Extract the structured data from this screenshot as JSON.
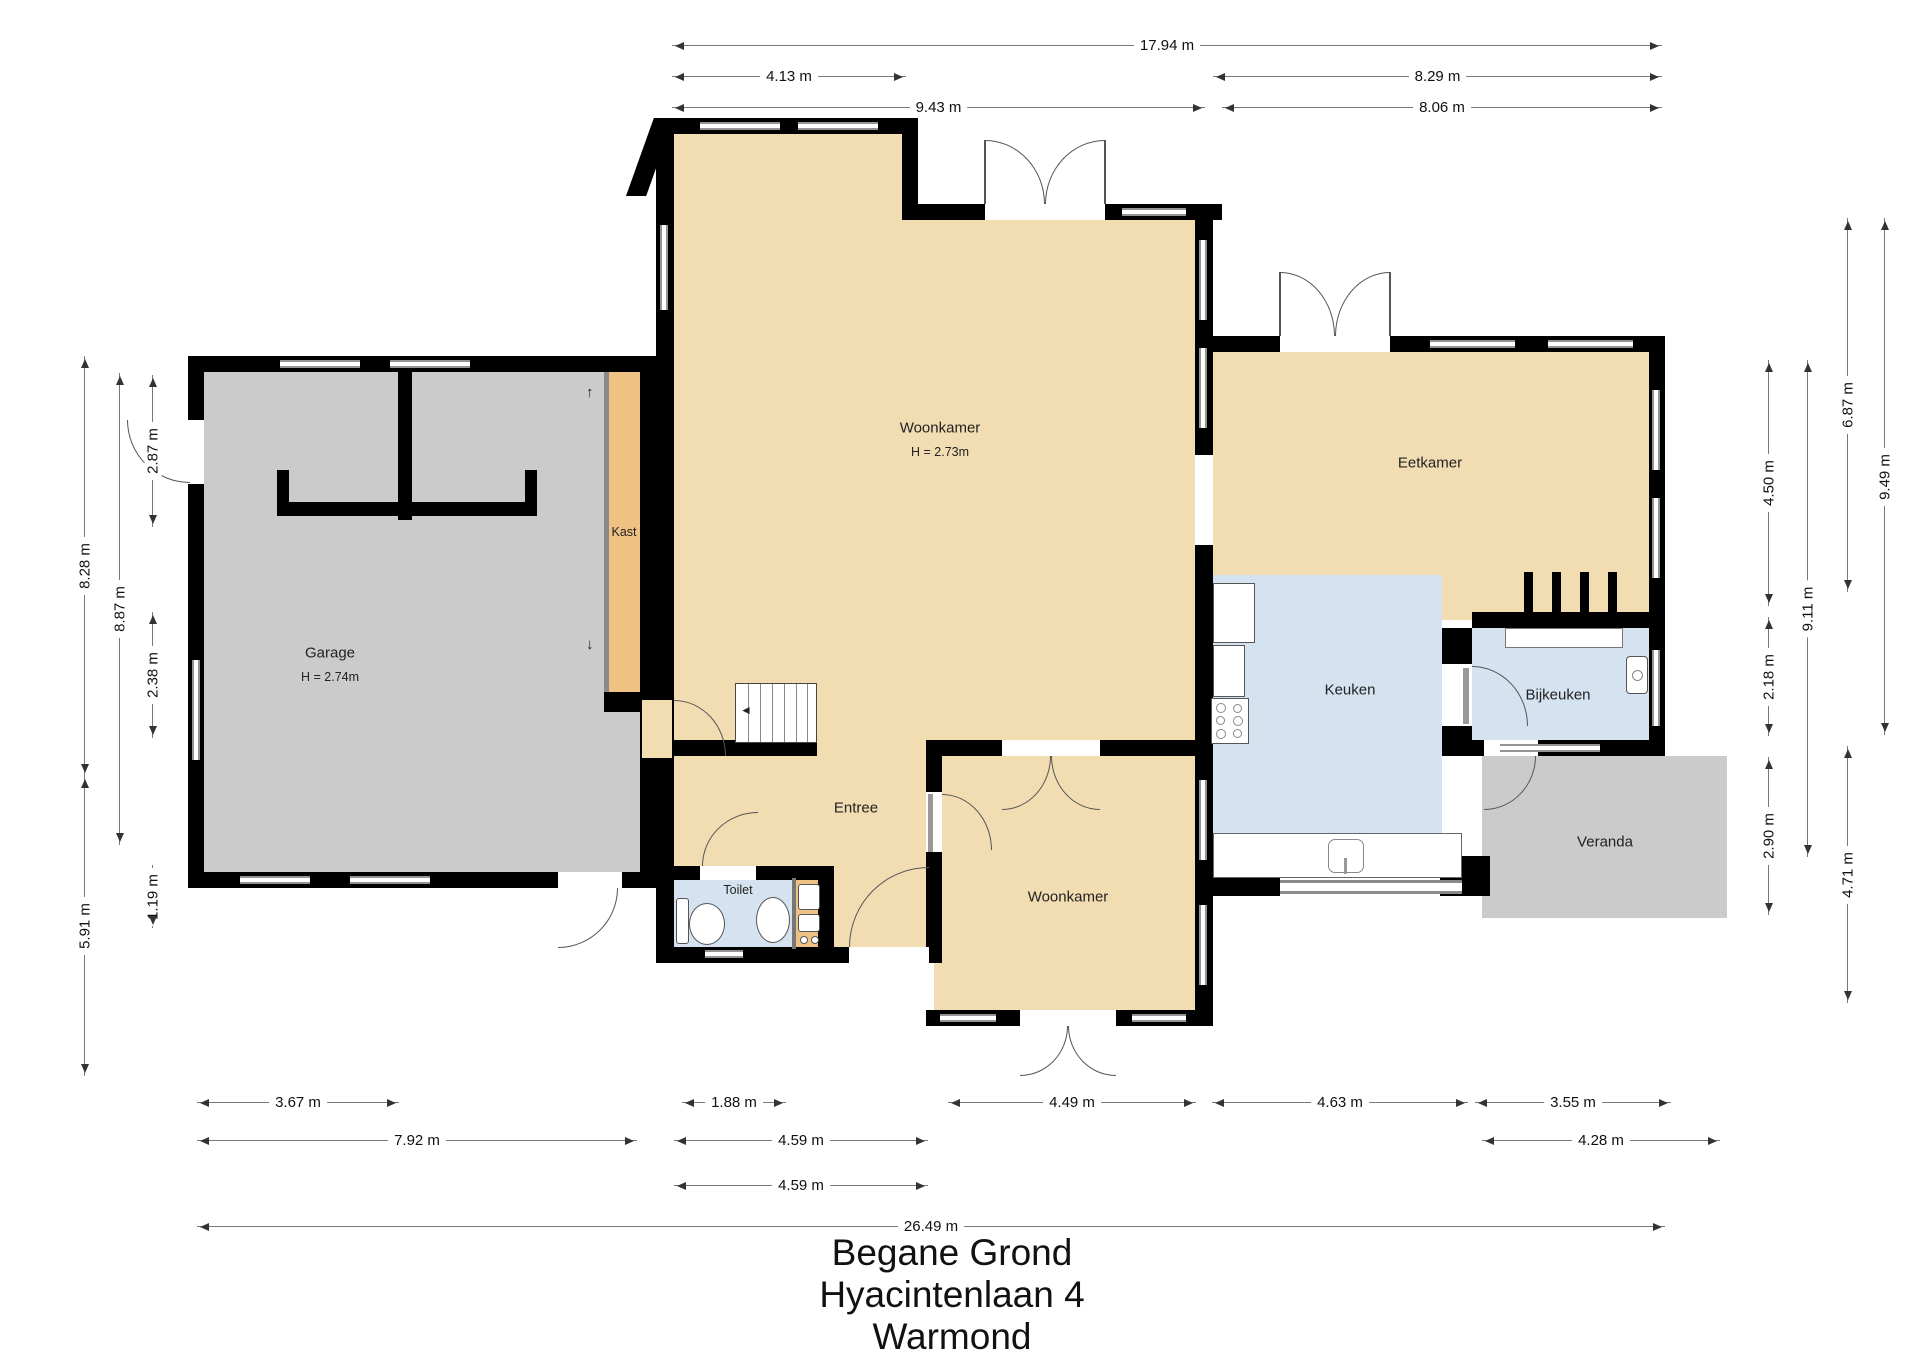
{
  "title": {
    "line1": "Begane Grond",
    "line2": "Hyacintenlaan 4",
    "line3": "Warmond"
  },
  "rooms": {
    "woonkamer_main": {
      "name": "Woonkamer",
      "height": "H = 2.73m"
    },
    "garage": {
      "name": "Garage",
      "height": "H = 2.74m"
    },
    "kast": {
      "name": "Kast"
    },
    "entree": {
      "name": "Entree"
    },
    "toilet": {
      "name": "Toilet"
    },
    "woonkamer_2": {
      "name": "Woonkamer"
    },
    "keuken": {
      "name": "Keuken"
    },
    "bijkeuken": {
      "name": "Bijkeuken"
    },
    "eetkamer": {
      "name": "Eetkamer"
    },
    "veranda": {
      "name": "Veranda"
    }
  },
  "dims": {
    "top_total": "17.94 m",
    "top_left": "4.13 m",
    "top_right": "8.29 m",
    "top_center_width": "9.43 m",
    "top_right_width": "8.06 m",
    "left_garage": "8.28 m",
    "left_lower": "5.91 m",
    "left_inner": "8.87 m",
    "left_seg_top": "2.87 m",
    "left_seg_mid": "2.38 m",
    "left_seg_bottom": "1.19 m",
    "right_upper": "6.87 m",
    "right_total": "9.49 m",
    "right_seg_top": "4.50 m",
    "right_inner": "9.11 m",
    "right_seg_mid": "2.18 m",
    "right_seg_bottom": "2.90 m",
    "right_lower": "4.71 m",
    "bottom_garage_seg": "3.67 m",
    "bottom_garage": "7.92 m",
    "bottom_entree_seg": "1.88 m",
    "bottom_entree": "4.59 m",
    "bottom_entree_2": "4.59 m",
    "bottom_woonkamer": "4.49 m",
    "bottom_keuken": "4.63 m",
    "bottom_bijkeuken": "3.55 m",
    "bottom_veranda": "4.28 m",
    "bottom_total": "26.49 m"
  },
  "icons": {
    "slide_up": "↑",
    "slide_down": "↓",
    "stairs_dir": "◄"
  },
  "colors": {
    "room_tan": "#f2ddb3",
    "closet_orange": "#efc183",
    "garage_gray": "#cbcbcb",
    "wet_room_blue": "#d5e3f0",
    "wall_black": "#000000"
  }
}
